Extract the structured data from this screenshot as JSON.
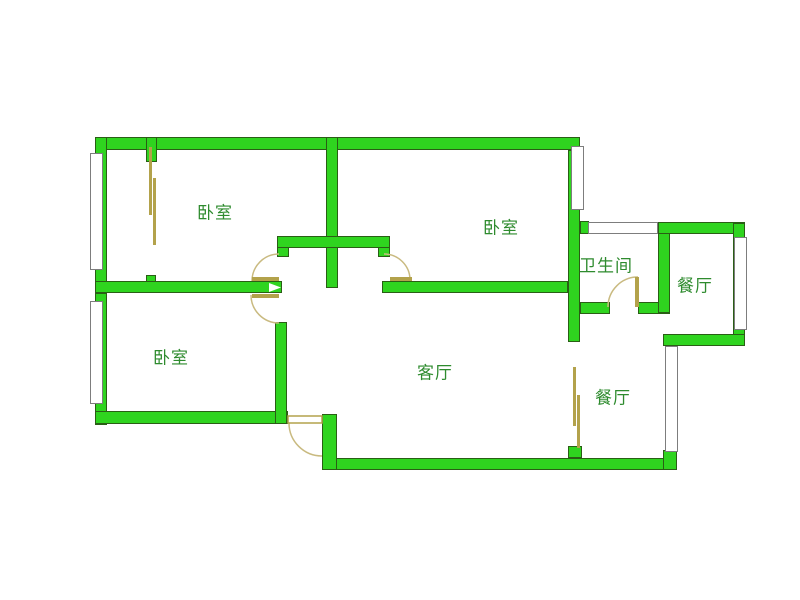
{
  "floorplan": {
    "type": "apartment-floor-plan",
    "background_color": "#ffffff",
    "colors": {
      "wall_fill": "#2fd41f",
      "wall_outline": "#2a5e15",
      "door_leaf": "#b3a24b",
      "door_arc": "#c9ba80",
      "window_frame": "#7d7d7d",
      "label_text": "#2e8b2e"
    },
    "rooms": [
      {
        "id": "bedroom-top-left",
        "label": "卧室"
      },
      {
        "id": "bedroom-top-right",
        "label": "卧室"
      },
      {
        "id": "bathroom",
        "label": "卫生间"
      },
      {
        "id": "dining-upper",
        "label": "餐厅"
      },
      {
        "id": "bedroom-bottom-left",
        "label": "卧室"
      },
      {
        "id": "living-room",
        "label": "客厅"
      },
      {
        "id": "dining-lower",
        "label": "餐厅"
      }
    ]
  }
}
